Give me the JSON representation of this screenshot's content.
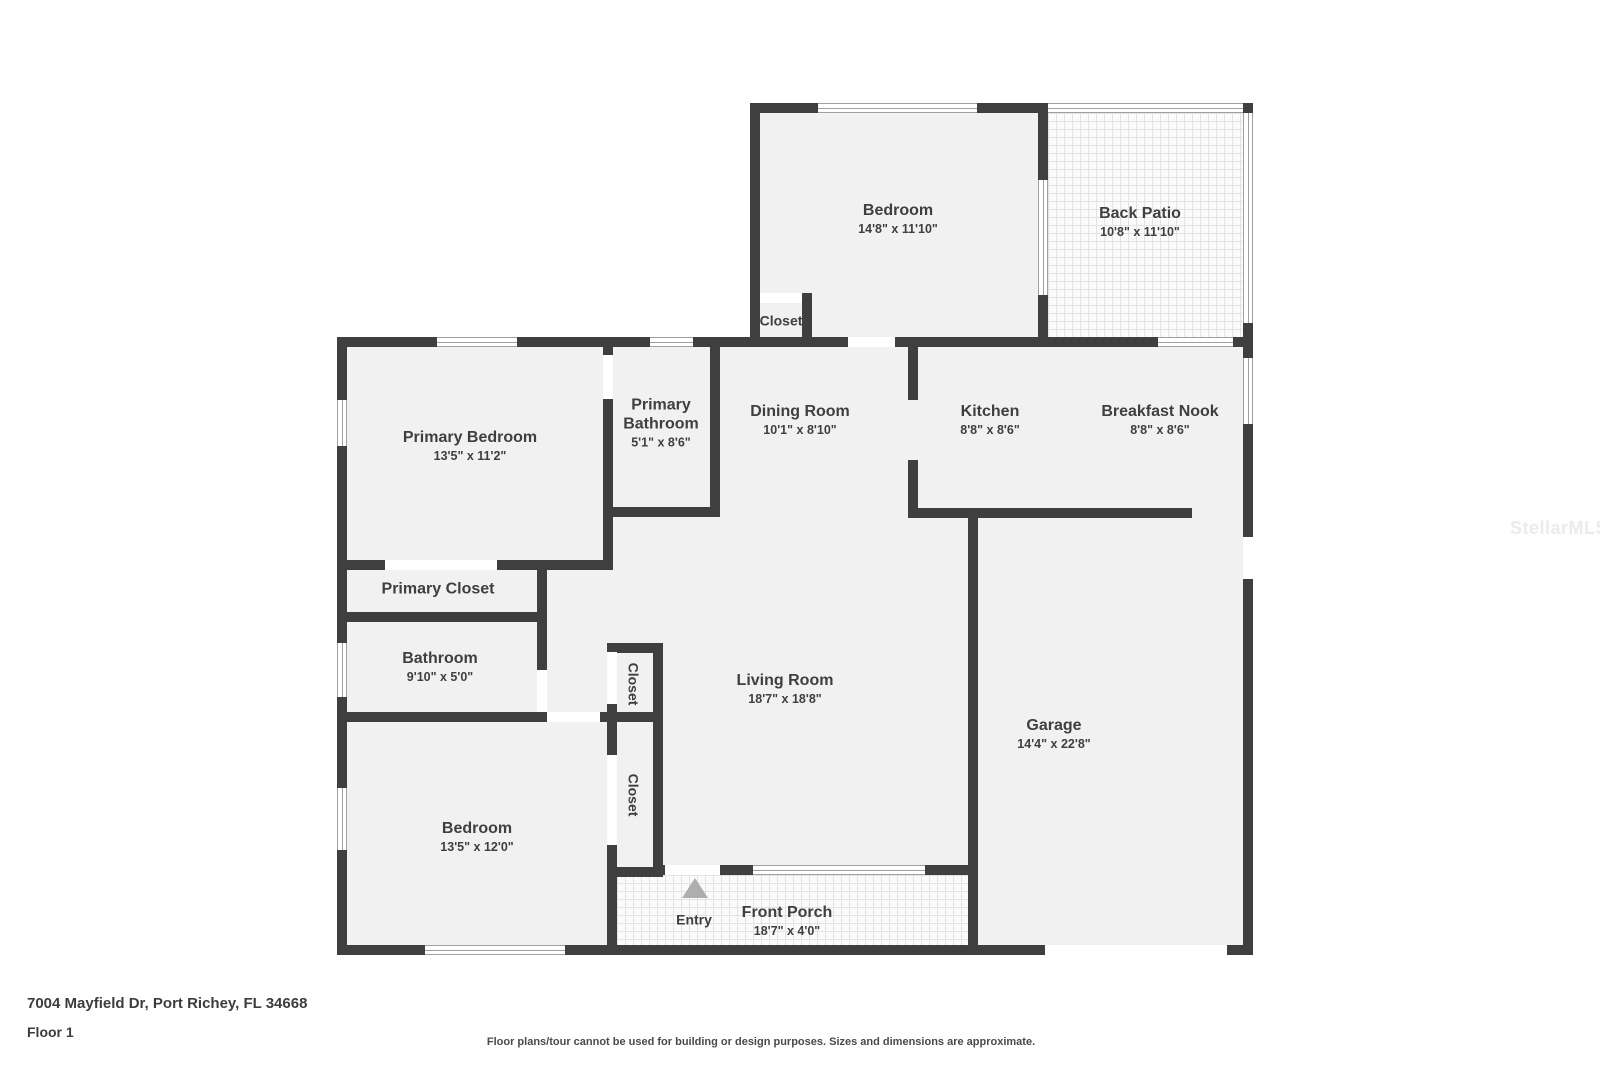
{
  "colors": {
    "wall": "#3f3f3f",
    "floor_fill": "#f1f1f2",
    "window_line": "#a0a0a0",
    "label_text": "#3f3f3f",
    "entry_arrow": "#aeaeae",
    "watermark_text": "#ebebeb"
  },
  "rooms": {
    "bedroom_top": {
      "name": "Bedroom",
      "dims": "14'8\" x 11'10\""
    },
    "back_patio": {
      "name": "Back Patio",
      "dims": "10'8\" x 11'10\""
    },
    "closet_top": {
      "name": "Closet"
    },
    "primary_bedroom": {
      "name": "Primary Bedroom",
      "dims": "13'5\" x 11'2\""
    },
    "primary_bathroom": {
      "name": "Primary Bathroom",
      "dims": "5'1\" x 8'6\""
    },
    "dining_room": {
      "name": "Dining Room",
      "dims": "10'1\" x 8'10\""
    },
    "kitchen": {
      "name": "Kitchen",
      "dims": "8'8\" x 8'6\""
    },
    "breakfast_nook": {
      "name": "Breakfast Nook",
      "dims": "8'8\" x 8'6\""
    },
    "primary_closet": {
      "name": "Primary Closet"
    },
    "bathroom": {
      "name": "Bathroom",
      "dims": "9'10\" x 5'0\""
    },
    "closet_hall_upper": {
      "name": "Closet"
    },
    "closet_hall_lower": {
      "name": "Closet"
    },
    "living_room": {
      "name": "Living Room",
      "dims": "18'7\" x 18'8\""
    },
    "garage": {
      "name": "Garage",
      "dims": "14'4\" x 22'8\""
    },
    "bedroom_lower": {
      "name": "Bedroom",
      "dims": "13'5\" x 12'0\""
    },
    "entry": {
      "name": "Entry"
    },
    "front_porch": {
      "name": "Front Porch",
      "dims": "18'7\" x 4'0\""
    }
  },
  "footer": {
    "address": "7004 Mayfield Dr, Port Richey, FL 34668",
    "floor_label": "Floor 1",
    "disclaimer": "Floor plans/tour cannot be used for building or design purposes. Sizes and dimensions are approximate."
  },
  "watermark": "StellarMLS"
}
